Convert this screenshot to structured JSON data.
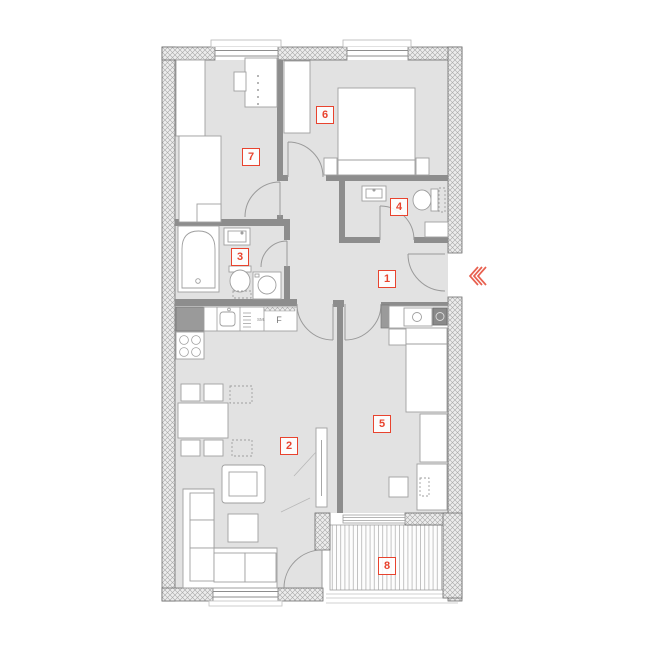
{
  "rooms": [
    {
      "number": "1"
    },
    {
      "number": "2"
    },
    {
      "number": "3"
    },
    {
      "number": "4"
    },
    {
      "number": "5"
    },
    {
      "number": "6"
    },
    {
      "number": "7"
    },
    {
      "number": "8"
    }
  ],
  "kitchen": {
    "fridge_label": "F",
    "dishwasher_label": "SM."
  },
  "colors": {
    "label_red": "#e8432e",
    "entrance_arrow": "#e8604f",
    "floor_gray": "#e2e2e2",
    "wall_gray": "#8d8d8d"
  }
}
